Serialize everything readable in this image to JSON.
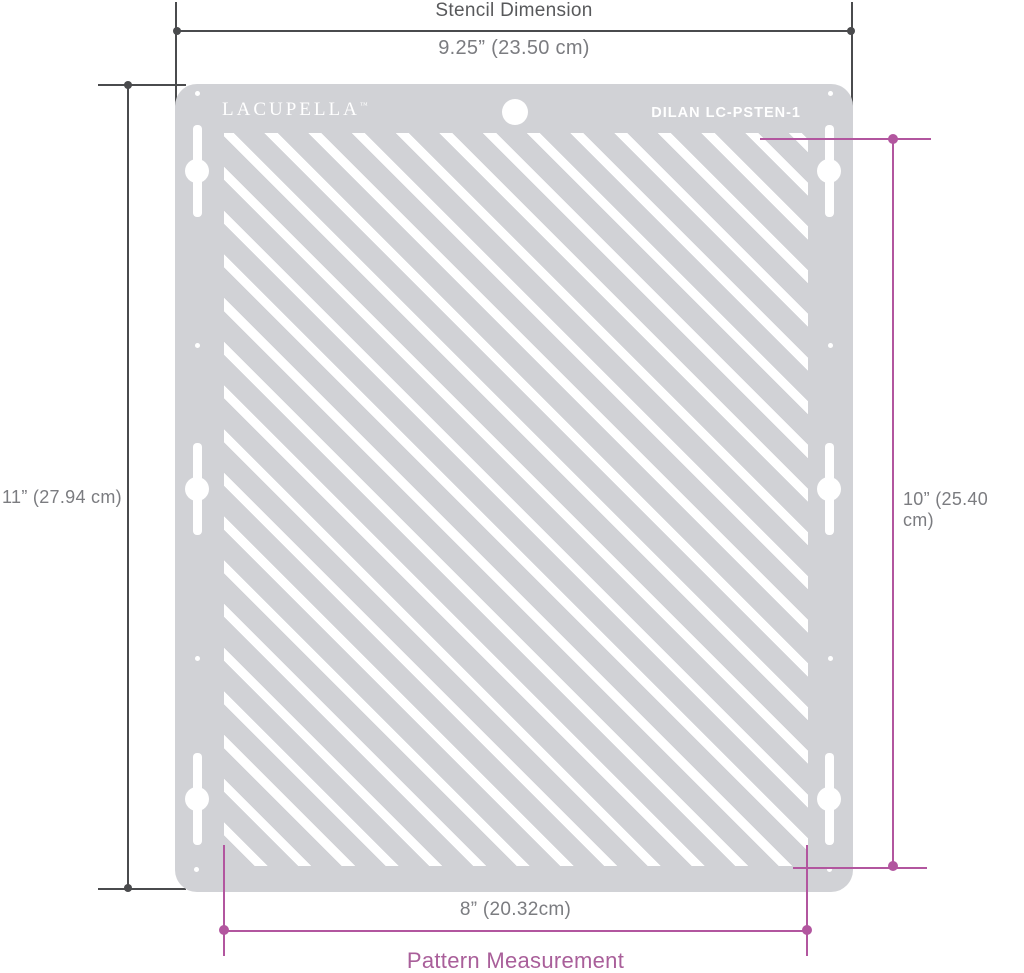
{
  "product": {
    "brand": "LACUPELLA",
    "brand_tm": "™",
    "model_code": "DILAN  LC-PSTEN-1"
  },
  "dimensions": {
    "top": {
      "title": "Stencil Dimension",
      "value": "9.25” (23.50 cm)"
    },
    "left": {
      "value": "11” (27.94 cm)"
    },
    "right": {
      "value": "10” (25.40 cm)"
    },
    "bottom": {
      "value": "8” (20.32cm)",
      "title": "Pattern Measurement"
    }
  },
  "colors": {
    "stencil_gray": "#d1d2d6",
    "dimension_dark": "#4a4b4d",
    "measurement_text_gray": "#7b7c80",
    "accent_pink": "#b2569f"
  }
}
